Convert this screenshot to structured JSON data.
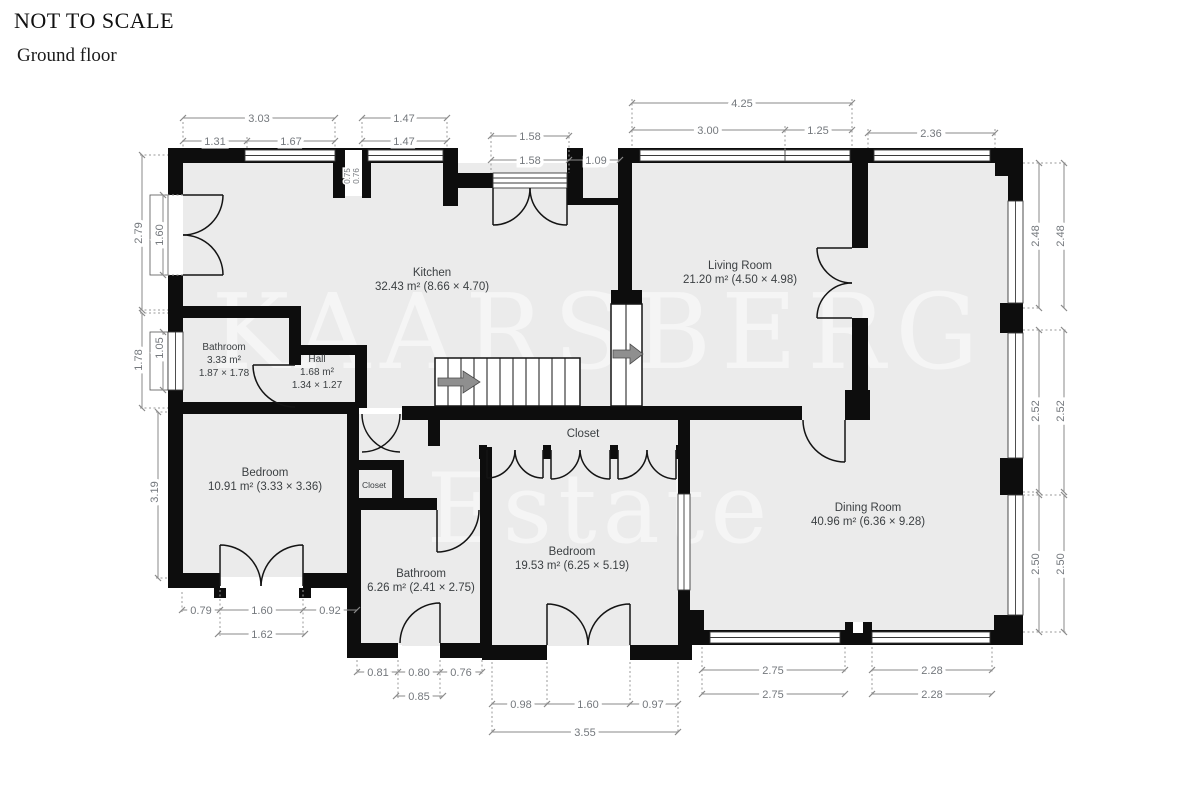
{
  "header": {
    "scale_note": "NOT TO SCALE",
    "floor": "Ground floor"
  },
  "watermark": {
    "line1": "KAARSBERG",
    "line2": "Estate"
  },
  "rooms": {
    "kitchen": {
      "name": "Kitchen",
      "details": "32.43 m² (8.66 × 4.70)"
    },
    "living": {
      "name": "Living Room",
      "details": "21.20 m² (4.50 × 4.98)"
    },
    "bathroom1": {
      "name": "Bathroom",
      "area": "3.33 m²",
      "size": "1.87 × 1.78"
    },
    "hall": {
      "name": "Hall",
      "area": "1.68 m²",
      "size": "1.34 × 1.27"
    },
    "bedroom1": {
      "name": "Bedroom",
      "details": "10.91 m² (3.33 × 3.36)"
    },
    "closet_small": {
      "name": "Closet"
    },
    "closet": {
      "name": "Closet"
    },
    "dining": {
      "name": "Dining Room",
      "details": "40.96 m² (6.36 × 9.28)"
    },
    "bedroom2": {
      "name": "Bedroom",
      "details": "19.53 m² (6.25 × 5.19)"
    },
    "bathroom2": {
      "name": "Bathroom",
      "details": "6.26 m² (2.41 × 2.75)"
    }
  },
  "dims": {
    "top": [
      "3.03",
      "1.31",
      "1.67",
      "1.47",
      "1.47",
      "1.58",
      "1.58",
      "1.09",
      "4.25",
      "3.00",
      "1.25",
      "2.36"
    ],
    "niche": [
      "0.75",
      "0.76"
    ],
    "left": [
      "2.79",
      "1.60",
      "1.78",
      "1.05",
      "3.19"
    ],
    "right": [
      "2.48",
      "2.48",
      "2.52",
      "2.52",
      "2.50",
      "2.50"
    ],
    "bottom": [
      "0.79",
      "1.60",
      "0.92",
      "1.62",
      "0.81",
      "0.80",
      "0.76",
      "0.85",
      "0.98",
      "1.60",
      "0.97",
      "3.55",
      "2.75",
      "2.75",
      "2.28",
      "2.28"
    ]
  },
  "colors": {
    "wall": "#0d0d0d",
    "floor": "#ebebeb",
    "dimension": "#8a8a8a"
  }
}
